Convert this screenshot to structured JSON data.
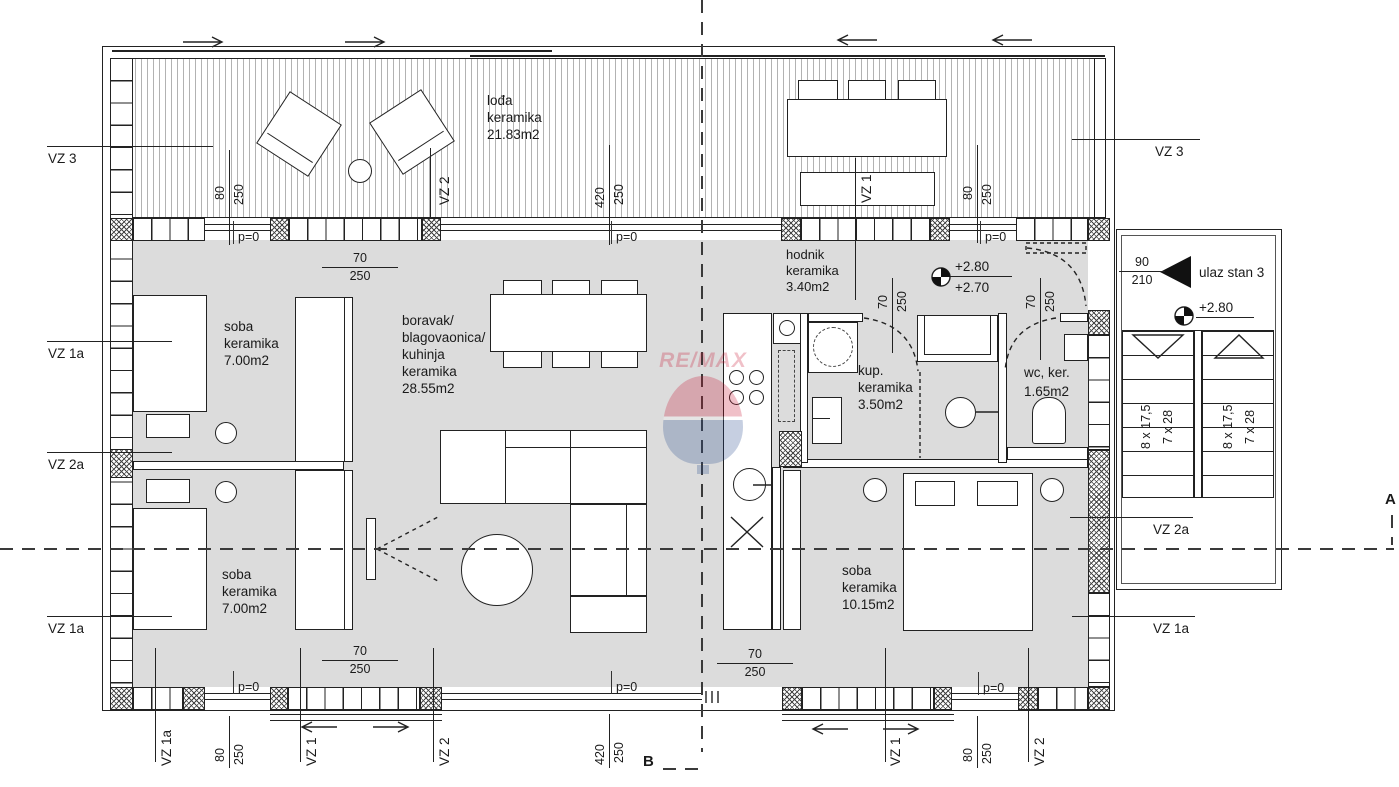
{
  "rooms": {
    "loggia": {
      "name": "lođa",
      "material": "keramika",
      "area": "21.83m2"
    },
    "room1": {
      "name": "soba",
      "material": "keramika",
      "area": "7.00m2"
    },
    "living": {
      "line1": "boravak/",
      "line2": "blagovaonica/",
      "line3": "kuhinja",
      "line4": "keramika",
      "line5": "28.55m2"
    },
    "hodnik": {
      "name": "hodnik",
      "material": "keramika",
      "area": "3.40m2"
    },
    "bathroom": {
      "line1": "kup.",
      "line2": "keramika",
      "line3": "3.50m2"
    },
    "wc": {
      "line1": "wc, ker.",
      "line2": "1.65m2"
    },
    "room2": {
      "name": "soba",
      "material": "keramika",
      "area": "7.00m2"
    },
    "room3": {
      "name": "soba",
      "material": "keramika",
      "area": "10.15m2"
    }
  },
  "dims": {
    "d70": "70",
    "d80": "80",
    "d90": "90",
    "d210": "210",
    "d250": "250",
    "d420": "420",
    "p0": "p=0"
  },
  "levels": {
    "upper": "+2.80",
    "lower": "+2.70",
    "stair": "+2.80"
  },
  "entrance": {
    "label": "ulaz stan 3"
  },
  "stairs": {
    "run1": "8 x 17,5",
    "run2": "7 x 28"
  },
  "vz": {
    "v1": "VZ 1",
    "v2": "VZ 2",
    "v3": "VZ 3",
    "v1a": "VZ 1a",
    "v2a": "VZ 2a"
  },
  "sections": {
    "a": "A",
    "b": "B"
  },
  "watermark": {
    "brand": "RE/MAX"
  },
  "colors": {
    "floor": "#dcdcdc",
    "line": "#1f1f1f",
    "remax_red": "#c8102e",
    "remax_blue": "#274b8f"
  }
}
